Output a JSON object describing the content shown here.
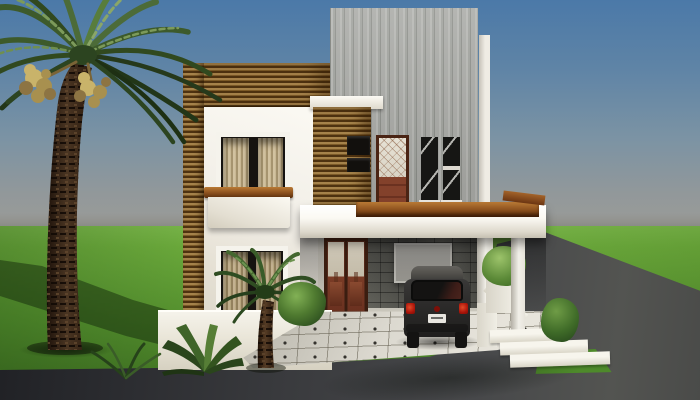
{
  "canvas": {
    "width": 700,
    "height": 400
  },
  "scene": {
    "type": "architectural-3d-render",
    "description": "Front-elevation 3D render of a modern two-storey house with wood-slat cladding, an exposed-concrete tower, a covered carport with a parked dark hatchback, a tiled driveway, lawn, asphalt street and a tall date palm on the left.",
    "objects": [
      "sky",
      "lawn",
      "asphalt-street",
      "date-palm-tree",
      "palm-shadow-on-lawn",
      "concrete-tower",
      "wood-clad-tower",
      "white-render-walls",
      "upper-window-with-tan-curtains",
      "lower-window-with-tan-curtains",
      "wood-balcony-rail",
      "white-balcony-planter",
      "terrace-slab",
      "terrace-wood-rail",
      "upper-balcony-door",
      "two-narrow-black-windows",
      "two-vent-slots",
      "entry-double-door",
      "entry-steps",
      "stone-carport-wall",
      "garage-panel",
      "carport-columns",
      "right-side-planter",
      "right-side-stairs",
      "white-tiled-driveway-with-dot-inlays",
      "parked-dark-hatchback-car",
      "small-foreground-palm",
      "agave-plant",
      "foliage-bushes"
    ]
  },
  "palette": {
    "sky_top": "#4b79a8",
    "sky_mid": "#7b93a4",
    "sky_horizon": "#9b9c98",
    "grass_light": "#6cab3c",
    "grass_mid": "#55912e",
    "grass_dark": "#3f7022",
    "road_dark": "#1d1e22",
    "road_mid": "#3a3b3e",
    "road_light": "#535451",
    "wood_light": "#a5824a",
    "wood_mid": "#7c5a28",
    "wood_dark": "#4e3210",
    "concrete_light": "#b4b5b1",
    "concrete_mid": "#9fa19c",
    "concrete_dark": "#8b8d88",
    "stone_dark": "#565650",
    "stone_light": "#72726a",
    "wall_white": "#f2efe8",
    "wall_shade": "#ddd8cb",
    "slab_white": "#fbf9f3",
    "door_maroon": "#7a3c26",
    "door_frame": "#432112",
    "glass_pale": "#d9d3c5",
    "black_glass": "#161614",
    "curtain_tan": "#c9b894",
    "rail_top": "#b97a35",
    "rail_dark": "#5a2e0d",
    "car_body": "#2c2b2a",
    "car_roof": "#56544f",
    "taillight_red": "#ab150a",
    "plate_white": "#e8e6e0",
    "tile_light": "#dcd9d0",
    "tile_dot": "#35332e",
    "palm_trunk": "#3a2817",
    "palm_dark": "#31491f",
    "palm_mid": "#4c6b38",
    "palm_light": "#7c9a5a",
    "fruit_tan": "#c2ab66"
  }
}
